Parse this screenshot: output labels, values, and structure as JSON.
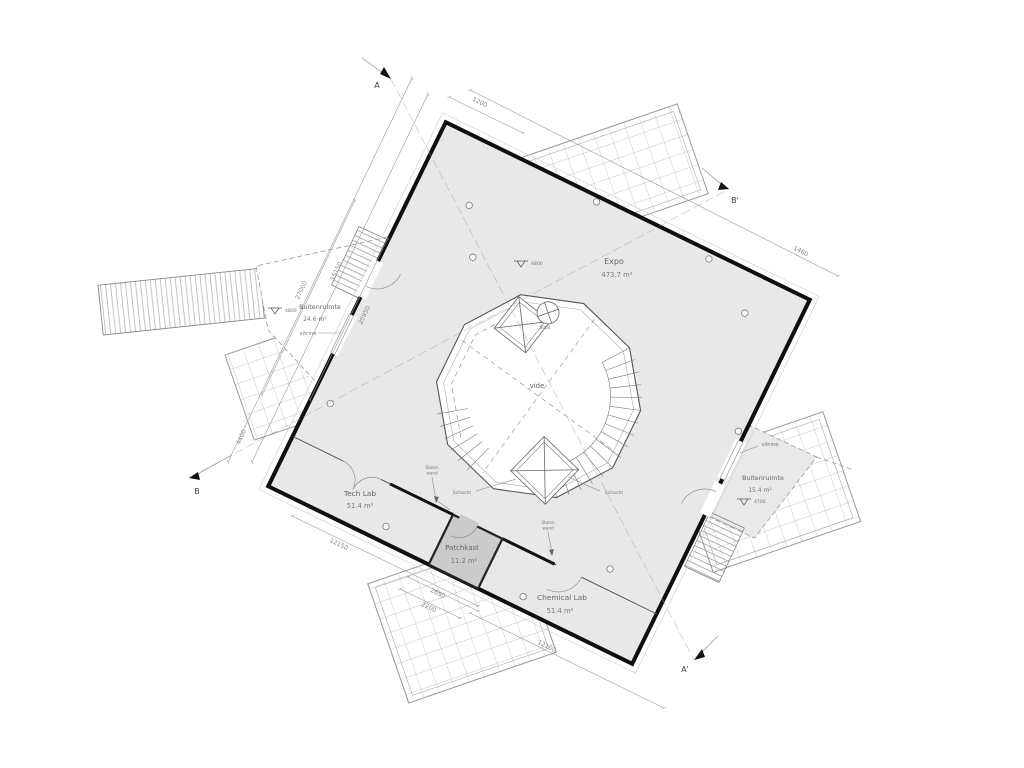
{
  "plan": {
    "rooms": {
      "expo": {
        "name": "Expo",
        "area": "473.7 m²"
      },
      "vide": {
        "name": "vide"
      },
      "tech_lab": {
        "name": "Tech Lab",
        "area": "51.4 m²"
      },
      "patchkast": {
        "name": "Patchkast",
        "area": "11.2 m²"
      },
      "chemical_lab": {
        "name": "Chemical Lab",
        "area": "51.4 m²"
      },
      "buitenruimte_left": {
        "name": "Buitenruimte",
        "area": "24.6 m²"
      },
      "buitenruimte_right": {
        "name": "Buitenruimte",
        "area": "15.4 m²"
      }
    },
    "labels": {
      "vitrine_left": "vitrine",
      "vitrine_right": "vitrine",
      "schacht_left": "Schacht",
      "schacht_right": "Schacht",
      "stalen_wand_1a": "Stalen",
      "stalen_wand_1b": "wand",
      "stalen_wand_2a": "Stalen",
      "stalen_wand_2b": "wand",
      "spil_dim": "8000"
    },
    "levels": {
      "left": "4800",
      "expo": "4800",
      "right": "4700"
    },
    "section_markers": {
      "a": "A",
      "a_prime": "A'",
      "b": "B",
      "b_prime": "B'"
    },
    "dimensions": {
      "top_corner": "1200",
      "top_edge": "1460",
      "left_outer": "15150",
      "left_outer2": "4400",
      "left_wall_1": "27000",
      "left_wall_2": "20950",
      "bottom_left": "12150",
      "bottom_trellis_1": "2650",
      "bottom_trellis_2": "2200",
      "bottom_right": "12100"
    },
    "colors": {
      "floor": "#e8e8e8",
      "patchkast": "#cbcbcb",
      "wall": "#0f0f0f"
    }
  }
}
